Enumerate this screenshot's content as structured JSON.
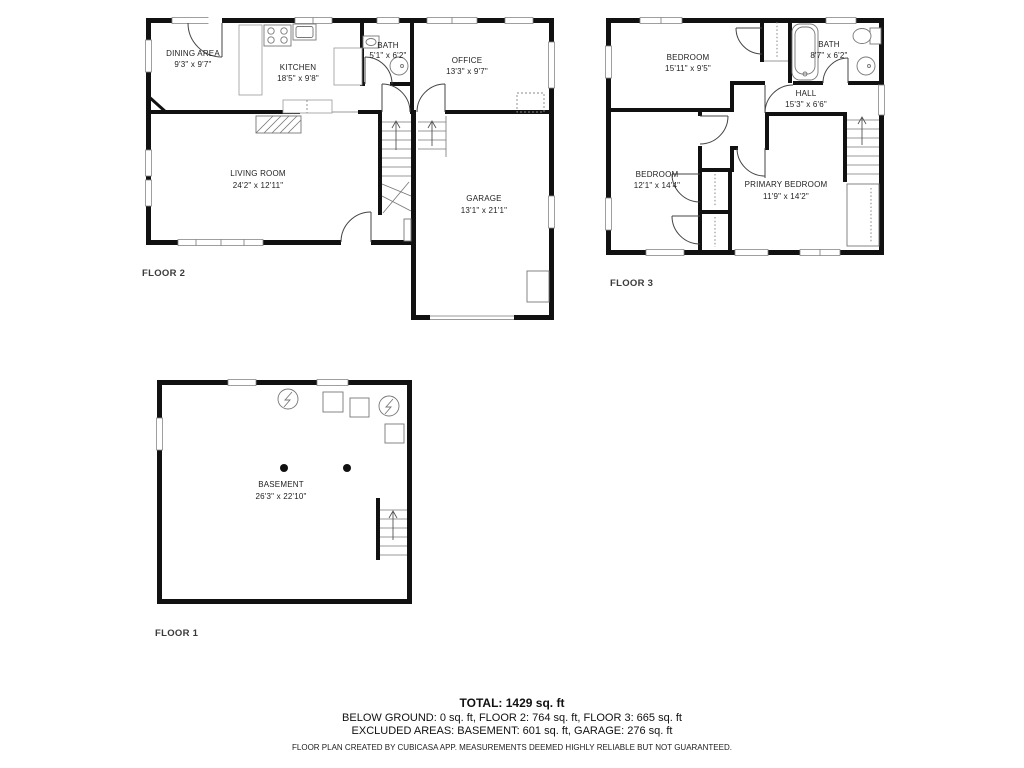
{
  "palette": {
    "wall": "#111111",
    "symbol_line": "#777777",
    "text": "#222222",
    "floor_label": "#3a3a3a"
  },
  "floors": {
    "floor2": {
      "label": "FLOOR 2",
      "rooms": {
        "dining": {
          "name": "DINING AREA",
          "dims": "9'3\" x 9'7\""
        },
        "kitchen": {
          "name": "KITCHEN",
          "dims": "18'5\" x 9'8\""
        },
        "bath": {
          "name": "BATH",
          "dims": "5'1\" x 6'2\""
        },
        "office": {
          "name": "OFFICE",
          "dims": "13'3\" x 9'7\""
        },
        "living": {
          "name": "LIVING ROOM",
          "dims": "24'2\" x 12'11\""
        },
        "garage": {
          "name": "GARAGE",
          "dims": "13'1\" x 21'1\""
        }
      }
    },
    "floor3": {
      "label": "FLOOR 3",
      "rooms": {
        "bedroom1": {
          "name": "BEDROOM",
          "dims": "15'11\" x 9'5\""
        },
        "bath": {
          "name": "BATH",
          "dims": "8'7\" x 6'2\""
        },
        "hall": {
          "name": "HALL",
          "dims": "15'3\" x 6'6\""
        },
        "bedroom2": {
          "name": "BEDROOM",
          "dims": "12'1\" x 14'4\""
        },
        "primary": {
          "name": "PRIMARY BEDROOM",
          "dims": "11'9\" x 14'2\""
        }
      }
    },
    "floor1": {
      "label": "FLOOR 1",
      "rooms": {
        "basement": {
          "name": "BASEMENT",
          "dims": "26'3\" x 22'10\""
        }
      }
    }
  },
  "summary": {
    "total": "TOTAL: 1429 sq. ft",
    "floors_line": "BELOW GROUND: 0 sq. ft, FLOOR 2: 764 sq. ft, FLOOR 3: 665 sq. ft",
    "excluded_line": "EXCLUDED AREAS: BASEMENT: 601 sq. ft, GARAGE: 276 sq. ft",
    "disclaimer": "FLOOR PLAN CREATED BY CUBICASA APP. MEASUREMENTS DEEMED HIGHLY RELIABLE BUT NOT GUARANTEED."
  }
}
